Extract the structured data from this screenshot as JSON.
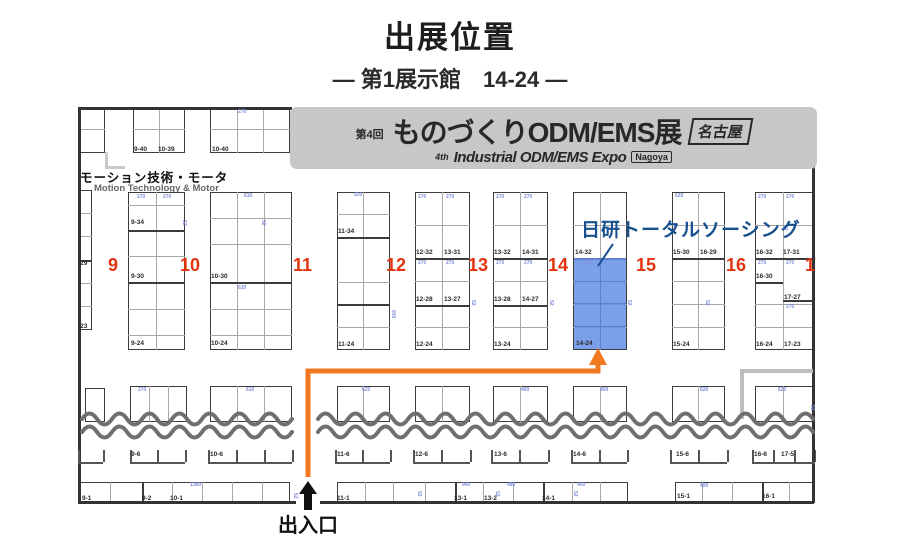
{
  "page": {
    "title": "出展位置",
    "subtitle": "― 第1展示館　14-24 ―"
  },
  "banner": {
    "edition": "第4回",
    "title": "ものづくりODM/EMS展",
    "city": "名古屋",
    "en_prefix": "4th",
    "en_title": "Industrial ODM/EMS Expo",
    "en_city": "Nagoya"
  },
  "section": {
    "jp": "モーション技術・モータ",
    "en": "Motion Technology & Motor"
  },
  "exhibitor": {
    "name": "日研トータルソーシング",
    "booth": "14-24"
  },
  "entrance": {
    "label": "出入口"
  },
  "colors": {
    "highlight": "#648fe5",
    "accent_red": "#e2330e",
    "route_orange": "#f0781e",
    "exhibitor_blue": "#19508e",
    "banner_bg": "#c7c7c9",
    "wall": "#333333",
    "wave": "#6f6f6f"
  },
  "map": {
    "column_numbers": [
      {
        "t": "9",
        "x": 30,
        "y": 150
      },
      {
        "t": "10",
        "x": 102,
        "y": 150
      },
      {
        "t": "11",
        "x": 215,
        "y": 150
      },
      {
        "t": "12",
        "x": 308,
        "y": 150
      },
      {
        "t": "13",
        "x": 390,
        "y": 150
      },
      {
        "t": "14",
        "x": 470,
        "y": 150
      },
      {
        "t": "15",
        "x": 558,
        "y": 150
      },
      {
        "t": "16",
        "x": 648,
        "y": 150
      },
      {
        "t": "17",
        "x": 727,
        "y": 150
      }
    ],
    "blocks": [
      {
        "x": 2,
        "y": 2,
        "w": 25,
        "h": 46,
        "vl": [],
        "hl": [
          22
        ]
      },
      {
        "x": 55,
        "y": 2,
        "w": 52,
        "h": 46,
        "vl": [
          26
        ],
        "hl": [
          22
        ]
      },
      {
        "x": 132,
        "y": 2,
        "w": 80,
        "h": 46,
        "vl": [
          27,
          53
        ],
        "hl": [
          22
        ]
      },
      {
        "x": 0,
        "y": 85,
        "w": 14,
        "h": 140,
        "vl": [],
        "hl": [
          23,
          46,
          93,
          116
        ],
        "dv": [
          {
            "y": 70
          }
        ]
      },
      {
        "x": 50,
        "y": 87,
        "w": 57,
        "h": 158,
        "vl": [
          28
        ],
        "hl": [
          13,
          64,
          117,
          143
        ],
        "dv": [
          {
            "y": 38
          },
          {
            "y": 90
          }
        ]
      },
      {
        "x": 132,
        "y": 87,
        "w": 82,
        "h": 158,
        "vl": [
          27,
          54
        ],
        "hl": [
          26,
          52,
          117,
          143
        ],
        "dv": [
          {
            "y": 90
          }
        ]
      },
      {
        "x": 259,
        "y": 87,
        "w": 53,
        "h": 158,
        "vl": [
          26
        ],
        "hl": [
          22,
          90,
          135
        ],
        "dv": [
          {
            "y": 45
          },
          {
            "y": 112
          }
        ]
      },
      {
        "x": 337,
        "y": 87,
        "w": 55,
        "h": 158,
        "vl": [
          27
        ],
        "hl": [
          33,
          89,
          135
        ],
        "dv": [
          {
            "y": 66
          },
          {
            "y": 113
          }
        ]
      },
      {
        "x": 415,
        "y": 87,
        "w": 55,
        "h": 158,
        "vl": [
          27
        ],
        "hl": [
          33,
          89,
          135
        ],
        "dv": [
          {
            "y": 66
          },
          {
            "y": 113
          }
        ]
      },
      {
        "x": 495,
        "y": 87,
        "w": 54,
        "h": 158,
        "vl": [
          27
        ],
        "hl": [
          33,
          89,
          112,
          135
        ],
        "dv": [
          {
            "y": 66
          }
        ]
      },
      {
        "x": 594,
        "y": 87,
        "w": 53,
        "h": 158,
        "vl": [
          26
        ],
        "hl": [
          33,
          89,
          112,
          135
        ],
        "dv": [
          {
            "y": 66
          }
        ]
      },
      {
        "x": 677,
        "y": 87,
        "w": 58,
        "h": 158,
        "vl": [
          28
        ],
        "hl": [
          33,
          112,
          135
        ],
        "dv": [
          {
            "y": 66
          },
          {
            "y": 90,
            "x1": 28
          },
          {
            "y": 108,
            "x0": 28
          }
        ]
      },
      {
        "x": 7,
        "y": 283,
        "w": 20,
        "h": 34,
        "vl": [],
        "hl": []
      },
      {
        "x": 52,
        "y": 281,
        "w": 57,
        "h": 36,
        "vl": [
          19,
          38
        ],
        "hl": []
      },
      {
        "x": 132,
        "y": 281,
        "w": 82,
        "h": 36,
        "vl": [
          27,
          54
        ],
        "hl": []
      },
      {
        "x": 259,
        "y": 281,
        "w": 53,
        "h": 36,
        "vl": [
          26
        ],
        "hl": []
      },
      {
        "x": 337,
        "y": 281,
        "w": 55,
        "h": 36,
        "vl": [
          27
        ],
        "hl": []
      },
      {
        "x": 415,
        "y": 281,
        "w": 55,
        "h": 36,
        "vl": [
          27
        ],
        "hl": []
      },
      {
        "x": 495,
        "y": 281,
        "w": 54,
        "h": 36,
        "vl": [
          27
        ],
        "hl": []
      },
      {
        "x": 594,
        "y": 281,
        "w": 53,
        "h": 36,
        "vl": [
          26
        ],
        "hl": []
      },
      {
        "x": 677,
        "y": 281,
        "w": 58,
        "h": 36,
        "vl": [
          28
        ],
        "hl": []
      },
      {
        "x": 2,
        "y": 377,
        "w": 210,
        "h": 21,
        "vl": [
          30,
          92,
          122,
          152,
          182
        ],
        "dv": [
          {
            "x": 62
          }
        ]
      },
      {
        "x": 259,
        "y": 377,
        "w": 291,
        "h": 21,
        "vl": [
          28,
          56,
          88,
          146,
          176,
          235,
          263
        ],
        "dv": [
          {
            "x": 118
          },
          {
            "x": 206
          }
        ]
      },
      {
        "x": 597,
        "y": 377,
        "w": 138,
        "h": 21,
        "vl": [
          27,
          57,
          114
        ],
        "dv": [
          {
            "x": 87
          }
        ]
      }
    ],
    "highlight_rect": {
      "x": 496,
      "y": 153,
      "w": 52,
      "h": 91,
      "vl": [
        26
      ],
      "hl": [
        23,
        45,
        68
      ]
    },
    "booth_labels": [
      {
        "t": "9-40",
        "x": 56,
        "y": 41
      },
      {
        "t": "10-39",
        "x": 80,
        "y": 41
      },
      {
        "t": "10-40",
        "x": 134,
        "y": 41
      },
      {
        "t": "-29",
        "x": 0,
        "y": 155
      },
      {
        "t": "-23",
        "x": 0,
        "y": 218
      },
      {
        "t": "9-34",
        "x": 53,
        "y": 114
      },
      {
        "t": "9-30",
        "x": 53,
        "y": 168
      },
      {
        "t": "9-24",
        "x": 53,
        "y": 235
      },
      {
        "t": "10-30",
        "x": 133,
        "y": 168
      },
      {
        "t": "10-24",
        "x": 133,
        "y": 235
      },
      {
        "t": "11-34",
        "x": 260,
        "y": 123
      },
      {
        "t": "11-24",
        "x": 260,
        "y": 236
      },
      {
        "t": "12-32",
        "x": 338,
        "y": 144
      },
      {
        "t": "13-31",
        "x": 366,
        "y": 144
      },
      {
        "t": "12-28",
        "x": 338,
        "y": 191
      },
      {
        "t": "13-27",
        "x": 366,
        "y": 191
      },
      {
        "t": "12-24",
        "x": 338,
        "y": 236
      },
      {
        "t": "13-32",
        "x": 416,
        "y": 144
      },
      {
        "t": "14-31",
        "x": 444,
        "y": 144
      },
      {
        "t": "13-28",
        "x": 416,
        "y": 191
      },
      {
        "t": "14-27",
        "x": 444,
        "y": 191
      },
      {
        "t": "13-24",
        "x": 416,
        "y": 236
      },
      {
        "t": "14-32",
        "x": 497,
        "y": 144
      },
      {
        "t": "14-24",
        "x": 498,
        "y": 235
      },
      {
        "t": "15-30",
        "x": 595,
        "y": 144
      },
      {
        "t": "16-29",
        "x": 622,
        "y": 144
      },
      {
        "t": "15-24",
        "x": 595,
        "y": 236
      },
      {
        "t": "16-32",
        "x": 678,
        "y": 144
      },
      {
        "t": "17-31",
        "x": 705,
        "y": 144
      },
      {
        "t": "16-30",
        "x": 678,
        "y": 168
      },
      {
        "t": "17-27",
        "x": 706,
        "y": 189
      },
      {
        "t": "16-24",
        "x": 678,
        "y": 236
      },
      {
        "t": "17-23",
        "x": 706,
        "y": 236
      },
      {
        "t": "9-6",
        "x": 53,
        "y": 346
      },
      {
        "t": "10-6",
        "x": 132,
        "y": 346
      },
      {
        "t": "11-6",
        "x": 259,
        "y": 346
      },
      {
        "t": "12-6",
        "x": 337,
        "y": 346
      },
      {
        "t": "13-6",
        "x": 416,
        "y": 346
      },
      {
        "t": "14-6",
        "x": 495,
        "y": 346
      },
      {
        "t": "15-6",
        "x": 598,
        "y": 346
      },
      {
        "t": "16-6",
        "x": 676,
        "y": 346
      },
      {
        "t": "17-5",
        "x": 703,
        "y": 346
      },
      {
        "t": "9-1",
        "x": 4,
        "y": 390
      },
      {
        "t": "9-2",
        "x": 64,
        "y": 390
      },
      {
        "t": "10-1",
        "x": 92,
        "y": 390
      },
      {
        "t": "11-1",
        "x": 259,
        "y": 390
      },
      {
        "t": "13-1",
        "x": 376,
        "y": 390
      },
      {
        "t": "13-2",
        "x": 406,
        "y": 390
      },
      {
        "t": "14-1",
        "x": 464,
        "y": 390
      },
      {
        "t": "15-1",
        "x": 599,
        "y": 388
      },
      {
        "t": "16-1",
        "x": 684,
        "y": 388
      }
    ],
    "area_numbers": [
      {
        "t": "270",
        "x": 59,
        "y": 90
      },
      {
        "t": "270",
        "x": 85,
        "y": 90
      },
      {
        "t": "610",
        "x": 166,
        "y": 89
      },
      {
        "t": "620",
        "x": 276,
        "y": 88
      },
      {
        "t": "270",
        "x": 340,
        "y": 90
      },
      {
        "t": "270",
        "x": 368,
        "y": 90
      },
      {
        "t": "270",
        "x": 418,
        "y": 90
      },
      {
        "t": "270",
        "x": 446,
        "y": 90
      },
      {
        "t": "620",
        "x": 597,
        "y": 89
      },
      {
        "t": "270",
        "x": 680,
        "y": 90
      },
      {
        "t": "270",
        "x": 708,
        "y": 90
      },
      {
        "t": "270",
        "x": 340,
        "y": 156
      },
      {
        "t": "270",
        "x": 368,
        "y": 156
      },
      {
        "t": "270",
        "x": 418,
        "y": 156
      },
      {
        "t": "270",
        "x": 446,
        "y": 156
      },
      {
        "t": "270",
        "x": 505,
        "y": 156
      },
      {
        "t": "270",
        "x": 680,
        "y": 156
      },
      {
        "t": "270",
        "x": 708,
        "y": 156
      },
      {
        "t": "270",
        "x": 708,
        "y": 200
      },
      {
        "t": "620",
        "x": 160,
        "y": 181
      },
      {
        "t": "270",
        "x": 160,
        "y": 5
      },
      {
        "t": "610",
        "x": 168,
        "y": 283
      },
      {
        "t": "620",
        "x": 284,
        "y": 283
      },
      {
        "t": "400",
        "x": 443,
        "y": 283
      },
      {
        "t": "400",
        "x": 522,
        "y": 283
      },
      {
        "t": "620",
        "x": 622,
        "y": 283
      },
      {
        "t": "620",
        "x": 700,
        "y": 283
      },
      {
        "t": "270",
        "x": 60,
        "y": 283
      },
      {
        "t": "1380",
        "x": 112,
        "y": 378
      },
      {
        "t": "960",
        "x": 384,
        "y": 378
      },
      {
        "t": "480",
        "x": 429,
        "y": 378
      },
      {
        "t": "400",
        "x": 499,
        "y": 378
      },
      {
        "t": "400",
        "x": 622,
        "y": 379
      },
      {
        "t": "52",
        "x": 103,
        "y": 115,
        "r": true
      },
      {
        "t": "52",
        "x": 182,
        "y": 115,
        "r": true
      },
      {
        "t": "930",
        "x": 312,
        "y": 205,
        "r": true
      },
      {
        "t": "52",
        "x": 392,
        "y": 195,
        "r": true
      },
      {
        "t": "52",
        "x": 470,
        "y": 195,
        "r": true
      },
      {
        "t": "52",
        "x": 548,
        "y": 195,
        "r": true
      },
      {
        "t": "52",
        "x": 626,
        "y": 195,
        "r": true
      },
      {
        "t": "52",
        "x": 704,
        "y": 120,
        "r": true
      },
      {
        "t": "52",
        "x": 731,
        "y": 300,
        "r": true
      },
      {
        "t": "52",
        "x": 214,
        "y": 388,
        "r": true
      },
      {
        "t": "52",
        "x": 338,
        "y": 386,
        "r": true
      },
      {
        "t": "52",
        "x": 416,
        "y": 386,
        "r": true
      },
      {
        "t": "52",
        "x": 494,
        "y": 386,
        "r": true
      }
    ],
    "bracket_row": {
      "y": 357,
      "tick_h": 12,
      "segments": [
        {
          "x0": 0,
          "x1": 25,
          "ticks": [
            0,
            25
          ]
        },
        {
          "x0": 52,
          "x1": 107,
          "ticks": [
            52,
            79,
            107
          ]
        },
        {
          "x0": 130,
          "x1": 214,
          "ticks": [
            130,
            158,
            186,
            214
          ]
        },
        {
          "x0": 257,
          "x1": 312,
          "ticks": [
            257,
            284,
            312
          ]
        },
        {
          "x0": 335,
          "x1": 392,
          "ticks": [
            335,
            363,
            392
          ]
        },
        {
          "x0": 413,
          "x1": 470,
          "ticks": [
            413,
            441,
            470
          ]
        },
        {
          "x0": 493,
          "x1": 549,
          "ticks": [
            493,
            521,
            549
          ]
        },
        {
          "x0": 592,
          "x1": 649,
          "ticks": [
            592,
            620,
            649
          ]
        },
        {
          "x0": 674,
          "x1": 737,
          "ticks": [
            674,
            695,
            716,
            737
          ]
        }
      ]
    },
    "walls": [
      {
        "x": 0,
        "y": 2,
        "w": 2.5,
        "h": 396
      },
      {
        "x": 0,
        "y": 2,
        "w": 214,
        "h": 2.5
      },
      {
        "x": 734,
        "y": 60,
        "w": 2.5,
        "h": 338
      },
      {
        "x": 0,
        "y": 396,
        "w": 218,
        "h": 3
      },
      {
        "x": 242,
        "y": 396,
        "w": 494,
        "h": 3
      },
      {
        "x": 27,
        "y": 47,
        "w": 2.5,
        "h": 16,
        "c": "#c9c9c9"
      },
      {
        "x": 27,
        "y": 61,
        "w": 20,
        "h": 2.5,
        "c": "#c9c9c9"
      },
      {
        "x": 662,
        "y": 264,
        "w": 73,
        "h": 4,
        "c": "#bdbdbd"
      },
      {
        "x": 662,
        "y": 264,
        "w": 4,
        "h": 50,
        "c": "#bdbdbd"
      }
    ],
    "waves": {
      "y1": 314,
      "y2": 327,
      "spans": [
        [
          4,
          215
        ],
        [
          240,
          735
        ]
      ],
      "amp": 11,
      "half": 15
    },
    "route": {
      "points": [
        [
          230,
          372
        ],
        [
          230,
          266
        ],
        [
          520,
          266
        ],
        [
          520,
          258
        ]
      ],
      "arrow": [
        [
          511,
          260
        ],
        [
          529,
          260
        ],
        [
          520,
          243
        ]
      ]
    },
    "pointer_line": [
      [
        535,
        139
      ],
      [
        520,
        161
      ]
    ]
  }
}
